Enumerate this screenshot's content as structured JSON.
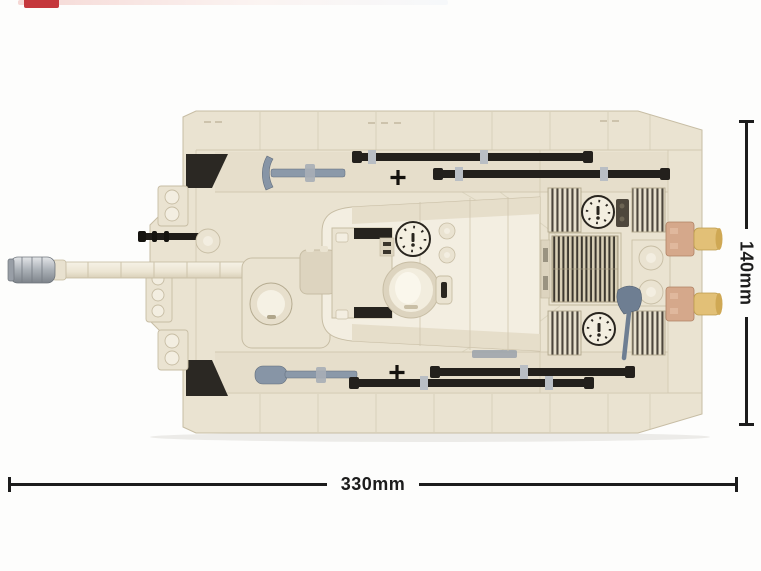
{
  "annotations": {
    "width_label": "330mm",
    "height_label": "140mm"
  },
  "logo": {
    "name": "brand-mark",
    "color": "#c5373c"
  },
  "colors": {
    "background": "#fdfdfc",
    "tank_cream": "#eae3d1",
    "tank_cream_light": "#f3eee1",
    "tank_cream_dark": "#ddd4bf",
    "seam": "#c7bda4",
    "track_black": "#23201c",
    "tool_steel": "#7e8da0",
    "muzzle_silver": "#b9bdc2",
    "exhaust_tan": "#e0bd74",
    "exhaust_base": "#d5a88b",
    "dim_line": "#1c1c1c",
    "logo_red": "#c5373c"
  },
  "model": {
    "view": "top",
    "parts": [
      "muzzle-brake",
      "gun-barrel",
      "mg-barrel",
      "ball-mount",
      "hull",
      "track-fenders",
      "pickaxe-tool",
      "sledgehammer-tool",
      "cleaning-rods",
      "cross-marker",
      "casemate",
      "loader-hatch",
      "dial-hatch",
      "commander-cupola",
      "engine-grilles",
      "fan-dials",
      "filler-caps",
      "shovel-tool",
      "exhaust-pipes"
    ]
  }
}
